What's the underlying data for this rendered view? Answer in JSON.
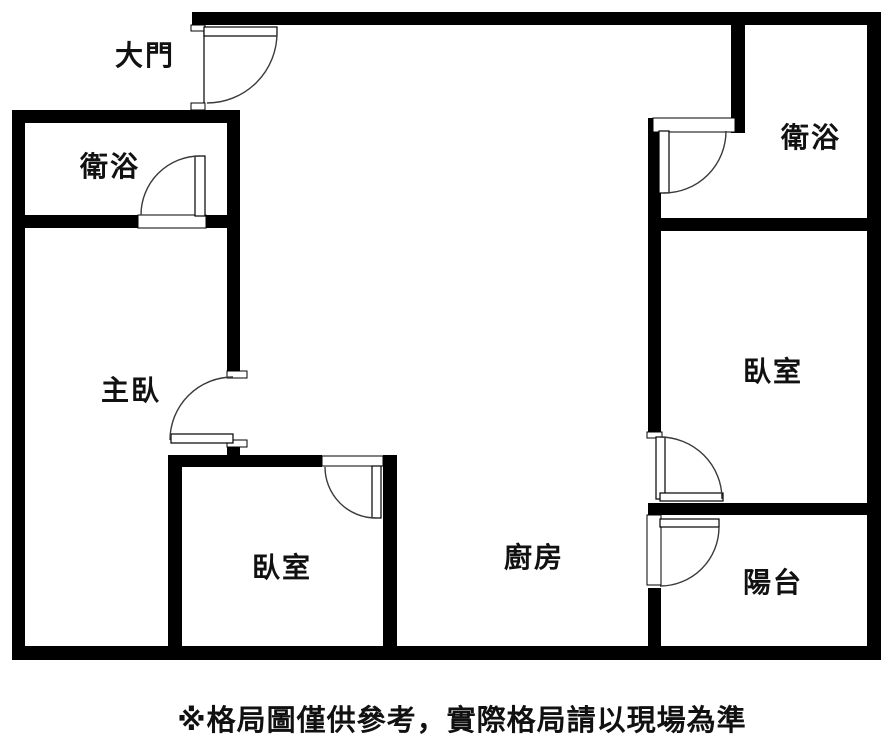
{
  "floor_plan": {
    "rooms": {
      "entrance": {
        "label": "大門"
      },
      "bathroom_left": {
        "label": "衛浴"
      },
      "master_bedroom": {
        "label": "主臥"
      },
      "bedroom_left": {
        "label": "臥室"
      },
      "kitchen": {
        "label": "廚房"
      },
      "bathroom_right": {
        "label": "衛浴"
      },
      "bedroom_right": {
        "label": "臥室"
      },
      "balcony": {
        "label": "陽台"
      }
    },
    "footer_note": "※格局圖僅供參考，實際格局請以現場為準",
    "colors": {
      "wall": "#000000",
      "background": "#ffffff",
      "door_swing": "#3a3a3a"
    }
  }
}
